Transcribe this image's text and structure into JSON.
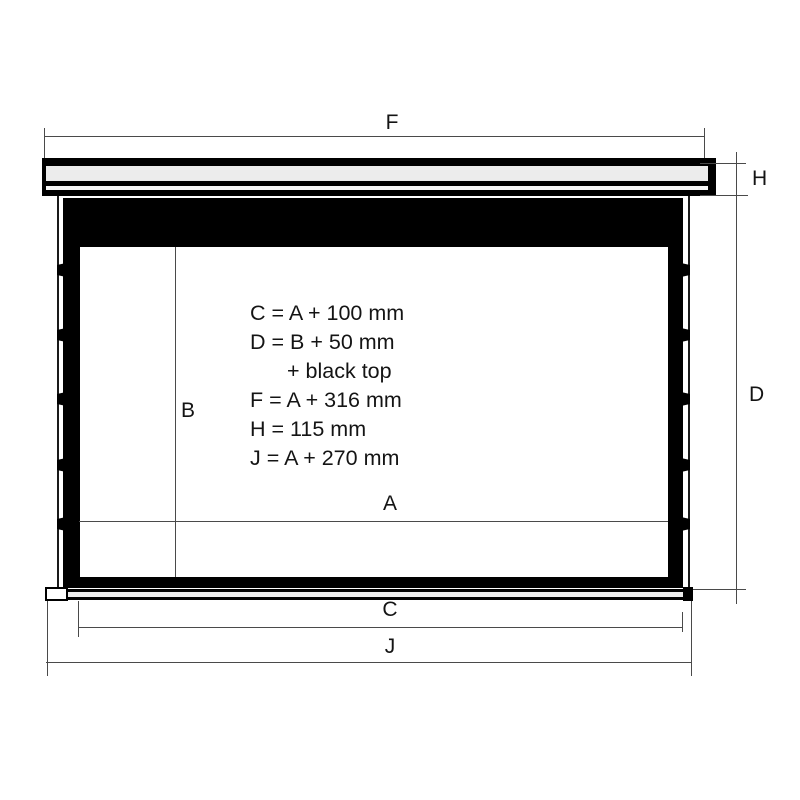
{
  "labels": {
    "F": "F",
    "H": "H",
    "D": "D",
    "B": "B",
    "A": "A",
    "C": "C",
    "J": "J"
  },
  "formulas": [
    "C = A + 100 mm",
    "D = B + 50 mm",
    "+ black top",
    "F = A + 316 mm",
    "H = 115 mm",
    "J = A + 270 mm"
  ],
  "colors": {
    "background": "#ffffff",
    "structure": "#000000",
    "dimension_line": "#4a4a4a",
    "housing_fill": "#ececec",
    "text": "#141414"
  }
}
